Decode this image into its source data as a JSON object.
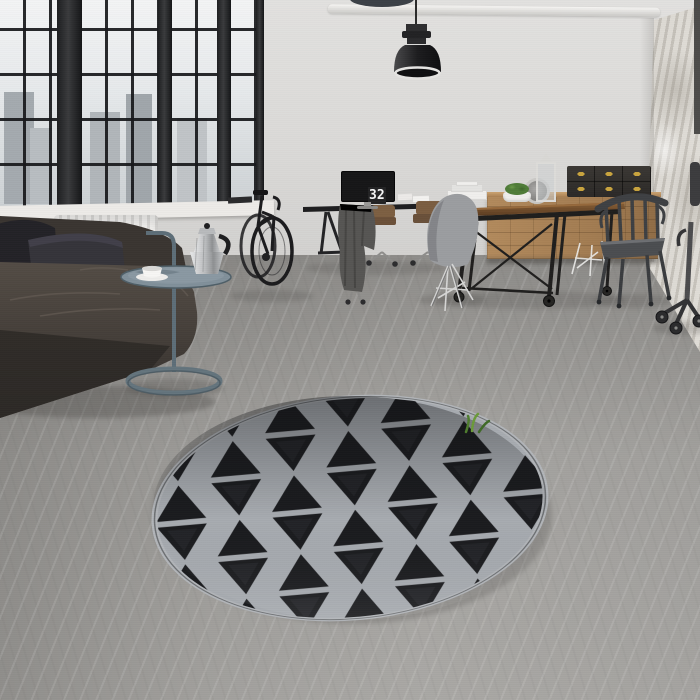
{
  "scene": {
    "title": "Industrial loft interior with round triangle-pattern rug",
    "clock": {
      "hours": "11",
      "minutes": "32"
    },
    "objects": [
      "grid-windows-with-city-view",
      "white-radiator",
      "dark-leather-sofa",
      "grey-cushions",
      "blue-grey-tray-side-table",
      "chrome-moka-pot",
      "white-coffee-cup",
      "black-bicycle",
      "black-desk",
      "flip-clock-monitor",
      "grey-draped-cloth",
      "rolling-chairs",
      "wooden-caster-table",
      "grey-shell-chair",
      "dark-metal-armchair",
      "wooden-drawer-sideboard",
      "black-storage-boxes",
      "white-lanterns",
      "moss-plant",
      "industrial-pendant-lamp",
      "round-triangle-pattern-rug",
      "distressed-plaster-wall",
      "ceiling-pipe",
      "office-chair"
    ],
    "palette": {
      "wall": "#dcdbd9",
      "floor": "#c6c5c3",
      "rug_dark": "#1a1b1e",
      "rug_grey": "#a7abb0",
      "sofa": "#453f3a",
      "wood": "#a87f52",
      "table_top": "#6f4d2e",
      "accent_table": "#6b7f8a",
      "brass": "#c9a43e",
      "clock_bg": "#161617",
      "clock_digits": "#f6f6f6"
    }
  }
}
